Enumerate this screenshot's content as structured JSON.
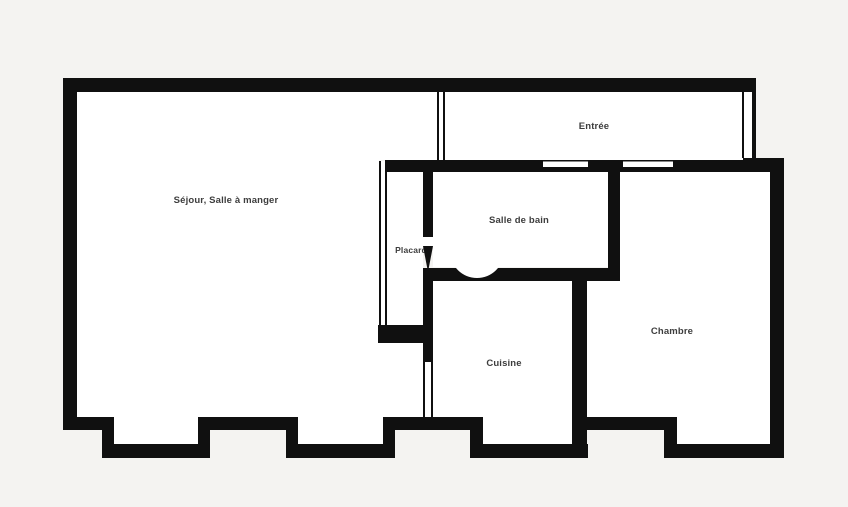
{
  "plan": {
    "type": "apartment-floor-plan",
    "colors": {
      "background": "#f4f3f1",
      "wall": "#101010",
      "floor": "#ffffff",
      "label": "#3d3d3d"
    },
    "rooms": [
      {
        "id": "sejour",
        "label": "Séjour, Salle à manger"
      },
      {
        "id": "entree",
        "label": "Entrée"
      },
      {
        "id": "salle-de-bain",
        "label": "Salle de bain"
      },
      {
        "id": "placard",
        "label": "Placard"
      },
      {
        "id": "cuisine",
        "label": "Cuisine"
      },
      {
        "id": "chambre",
        "label": "Chambre"
      }
    ]
  }
}
